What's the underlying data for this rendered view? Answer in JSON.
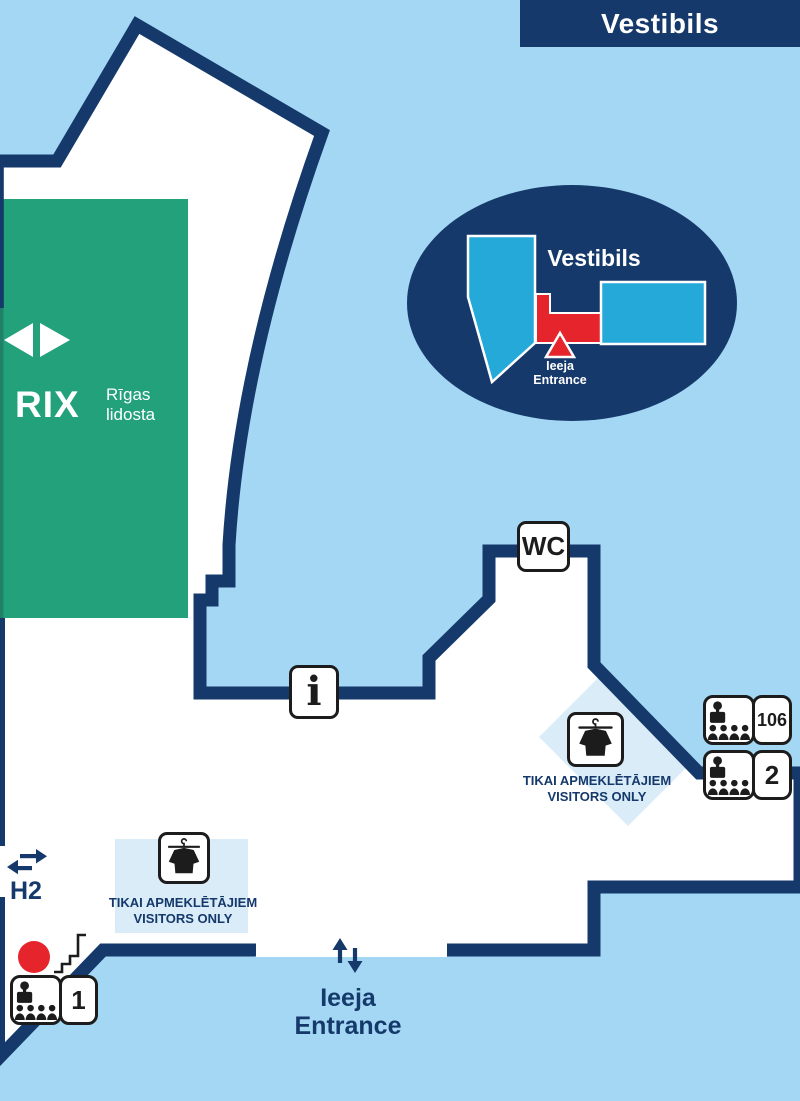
{
  "colors": {
    "background": "#a4d7f3",
    "navy": "#15396b",
    "green": "#22a17b",
    "green_edge": "#1e8168",
    "cyan": "#25a9d8",
    "red": "#e6242b",
    "pale_blue": "#d9ecf8",
    "white": "#ffffff",
    "icon_black": "#1c1c1c"
  },
  "banner": {
    "title": "Vestibils"
  },
  "logo": {
    "brand": "RIX",
    "sub1": "Rīgas",
    "sub2": "lidosta"
  },
  "inset": {
    "title": "Vestibils",
    "entrance_lv": "Ieeja",
    "entrance_en": "Entrance"
  },
  "signs": {
    "wc": "WC",
    "info": "i"
  },
  "coat_check": {
    "line1": "TIKAI APMEKLĒTĀJIEM",
    "line2": "VISITORS ONLY"
  },
  "rooms": {
    "room106": "106",
    "hall2": "2",
    "hall1": "1"
  },
  "exits": {
    "h2": "H2",
    "entrance_lv": "Ieeja",
    "entrance_en": "Entrance"
  },
  "icons": {
    "coat": "coat-on-hanger-icon",
    "audience": "reception-and-audience-icon",
    "stairs": "stairs-icon",
    "marker": "red-location-dot",
    "h2_arrows": "two-way-horizontal-arrows-icon",
    "entrance_arrows": "two-way-vertical-arrows-icon",
    "logo_arrows": "left-right-triangles-icon"
  }
}
